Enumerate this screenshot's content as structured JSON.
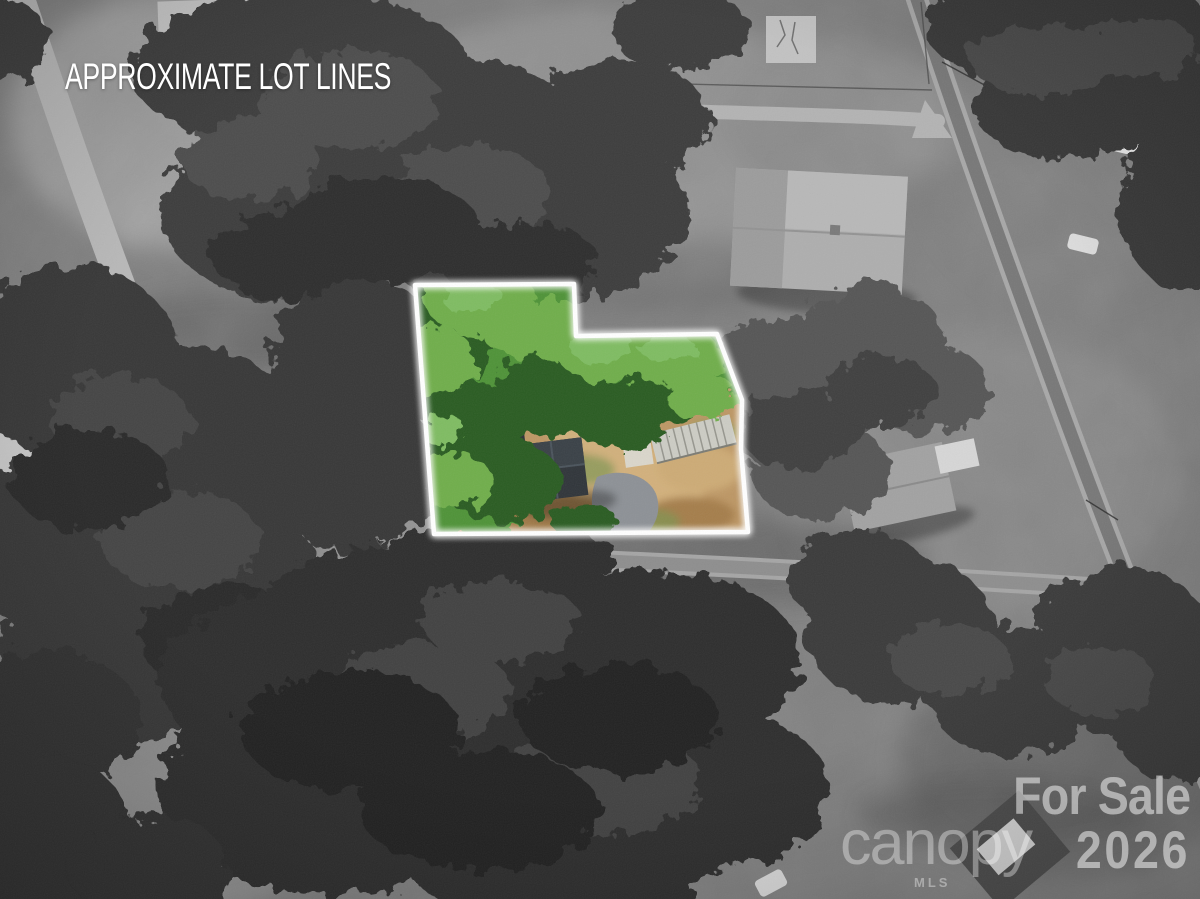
{
  "annotation": {
    "title": "APPROXIMATE LOT LINES"
  },
  "watermarks": {
    "for_sale_line1": "For Sale",
    "for_sale_line2": "2026",
    "mls_brand": "canopy",
    "mls_brand_sub": "MLS"
  },
  "lot": {
    "outline_points": "415,285 574,284 576,336 717,334 742,400 741,449 748,532 434,534",
    "outline_color": "#ffffff",
    "colors": {
      "ground": "#bd9765",
      "ground_light": "#d2b07c",
      "ground_dark": "#a07a48",
      "canopy_dark": "#2c5c22",
      "canopy_mid": "#4f9338",
      "canopy_light": "#6fae4c",
      "roof": "#30353a",
      "driveway": "#8d9196",
      "metal_roof": "#ccccc4"
    }
  }
}
